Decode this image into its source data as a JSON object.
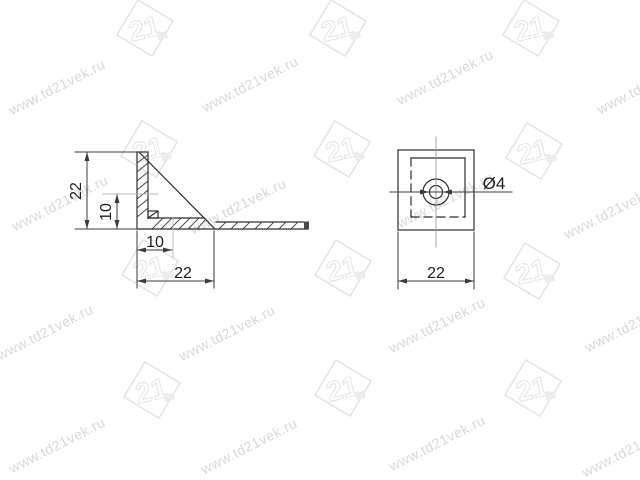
{
  "watermark": {
    "text": "www.td21vek.ru",
    "logo_text": "21"
  },
  "side_view": {
    "height_label": "22",
    "inner_height_label": "10",
    "inner_width_label": "10",
    "width_label": "22"
  },
  "top_view": {
    "hole_diameter_label": "Ø4",
    "width_label": "22"
  }
}
